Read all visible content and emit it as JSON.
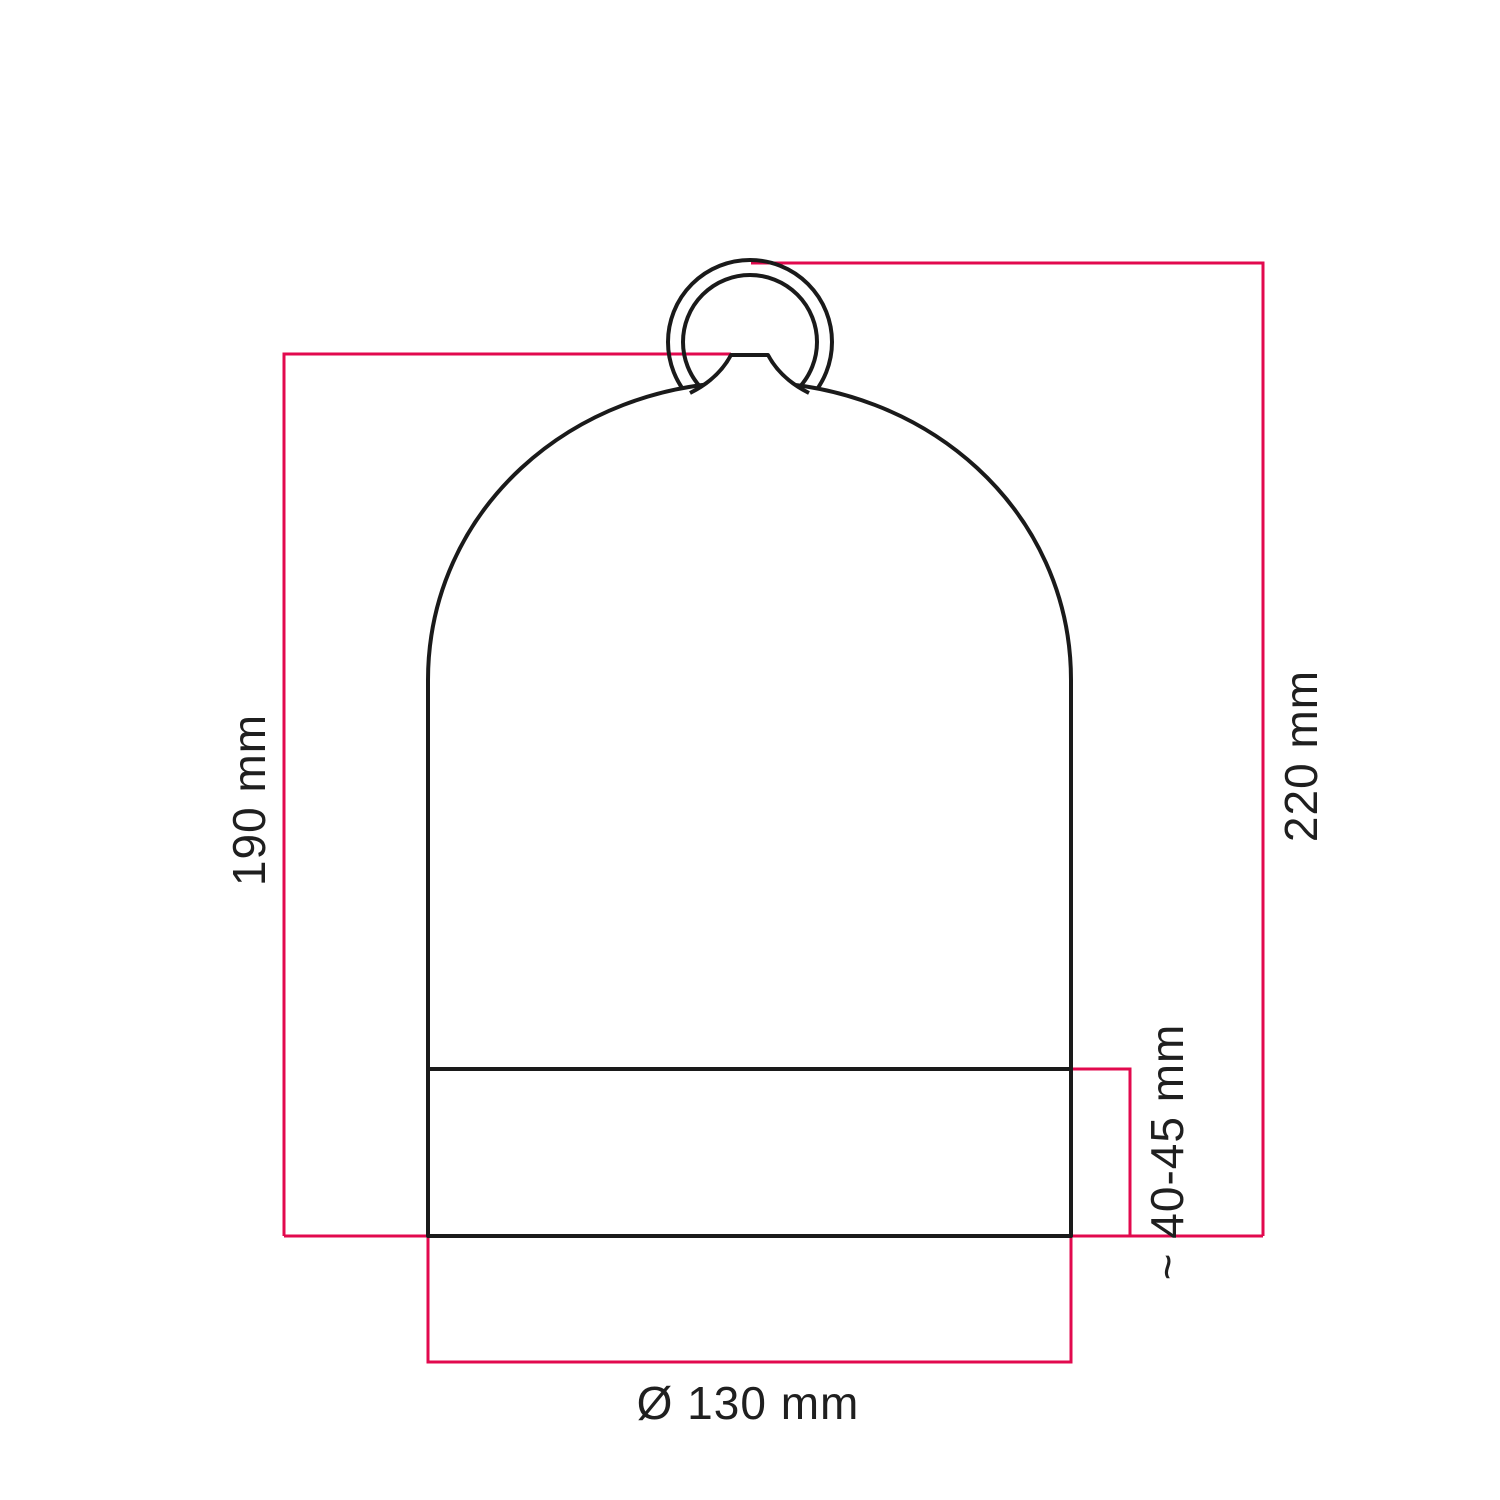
{
  "drawing": {
    "labels": {
      "inner_height": "190 mm",
      "total_height": "220 mm",
      "base_height": "~ 40-45 mm",
      "diameter": "Ø 130 mm"
    },
    "colors": {
      "dimension_line": "#e2094e",
      "outline": "#1a1a1a",
      "text": "#1f1f1f"
    }
  }
}
